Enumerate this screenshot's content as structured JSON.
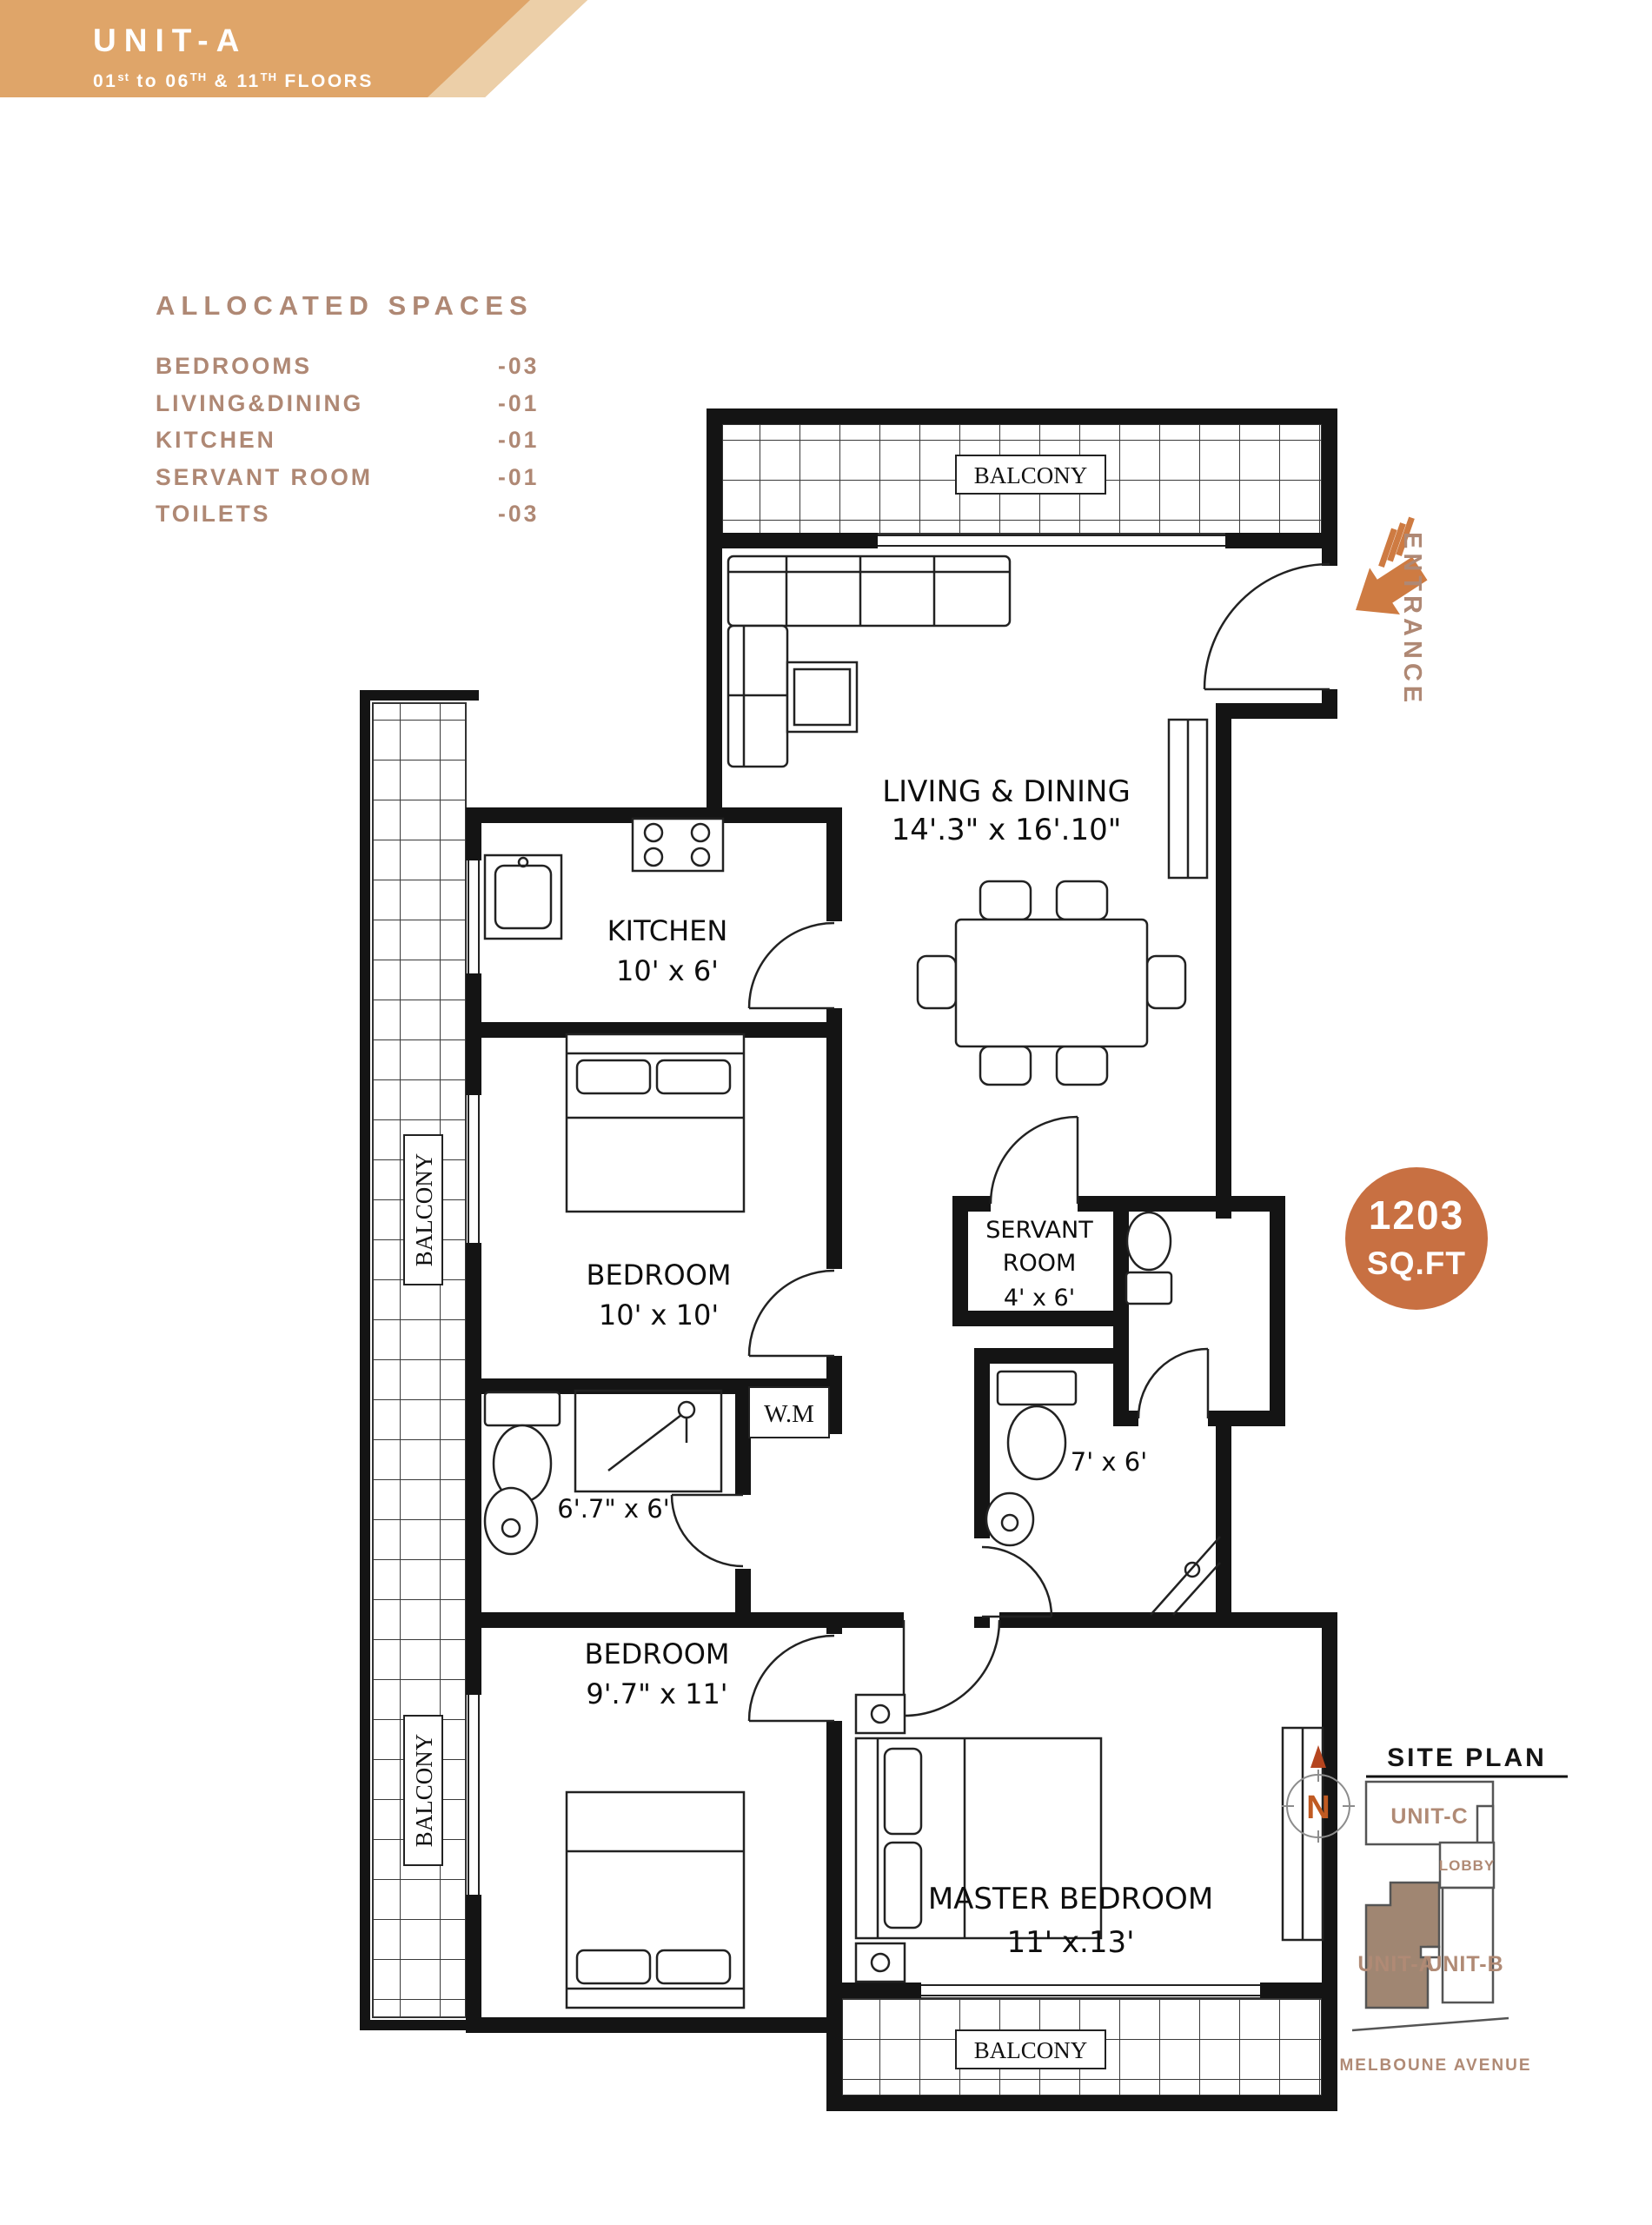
{
  "header": {
    "title": "UNIT-A",
    "floors": {
      "p1": "01",
      "s1": "st",
      "p2": " to 06",
      "s2": "TH",
      "p3": " & 11",
      "s3": "TH",
      "p4": " FLOORS"
    }
  },
  "allocated": {
    "title": "ALLOCATED SPACES",
    "items": [
      {
        "label": "BEDROOMS",
        "count": "-03"
      },
      {
        "label": "LIVING&DINING",
        "count": "-01"
      },
      {
        "label": "KITCHEN",
        "count": "-01"
      },
      {
        "label": "SERVANT ROOM",
        "count": "-01"
      },
      {
        "label": "TOILETS",
        "count": "-03"
      }
    ]
  },
  "plan": {
    "balcony": "BALCONY",
    "living": {
      "name": "LIVING & DINING",
      "dim": "14'.3\" x 16'.10\""
    },
    "kitchen": {
      "name": "KITCHEN",
      "dim": "10' x 6'"
    },
    "bedroom1": {
      "name": "BEDROOM",
      "dim": "10' x 10'"
    },
    "servant": {
      "l1": "SERVANT",
      "l2": "ROOM",
      "dim": "4' x 6'"
    },
    "toilet1": {
      "dim": "6'.7\" x 6'"
    },
    "toilet2": {
      "dim": "7' x 6'"
    },
    "wm": "W.M",
    "bedroom2": {
      "name": "BEDROOM",
      "dim": "9'.7\" x 11'"
    },
    "master": {
      "name": "MASTER BEDROOM",
      "dim": "11' x.13'"
    },
    "entrance": "ENTRANCE"
  },
  "badge": {
    "value": "1203",
    "unit": "SQ.FT"
  },
  "site": {
    "title": "SITE PLAN",
    "north": "N",
    "unit_c": "UNIT-C",
    "lobby": "LOBBY",
    "unit_a": "UNIT-A",
    "unit_b": "UNIT-B",
    "street": "MELBOUNE AVENUE"
  },
  "colors": {
    "banner": "#dfa569",
    "banner_stripe": "#eccfa8",
    "taupe": "#af8874",
    "accent_orange": "#ce7b42",
    "badge": "#c87042",
    "unit_a_fill": "#a08672"
  }
}
